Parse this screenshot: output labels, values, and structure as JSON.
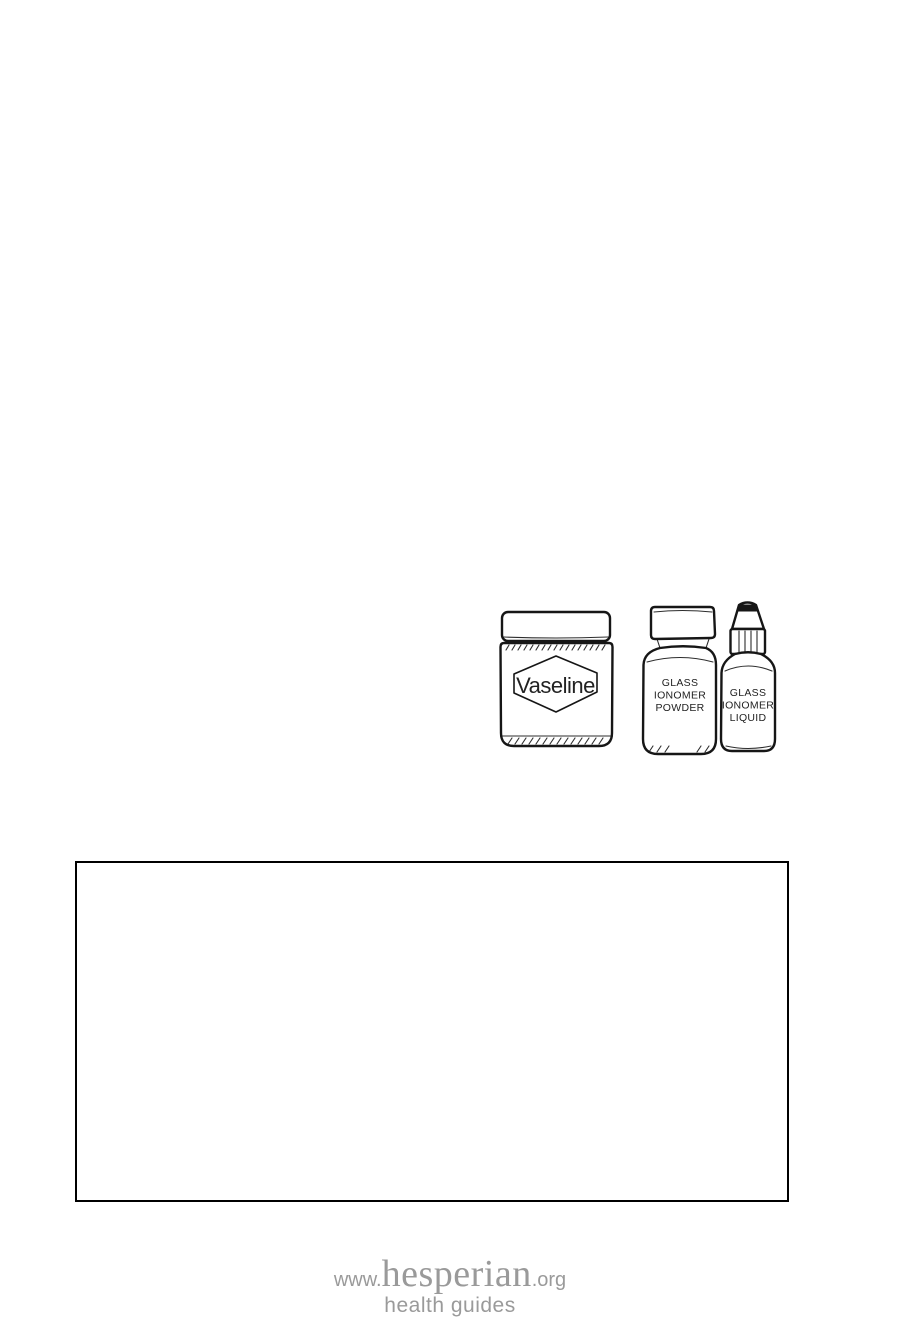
{
  "page": {
    "background": "#ffffff",
    "ink_color": "#161616"
  },
  "illustration": {
    "description": "line drawing of petroleum jelly jar, glass ionomer powder bottle, and glass ionomer liquid dropper bottle",
    "vaseline_label": "Vaseline",
    "powder_lines": [
      "GLASS",
      "IONOMER",
      "POWDER"
    ],
    "liquid_lines": [
      "GLASS",
      "IONOMER",
      "LIQUID"
    ]
  },
  "note_box": {
    "border_color": "#000000",
    "content": ""
  },
  "footer_logo": {
    "www": "www.",
    "name": "hesperian",
    "tld": ".org",
    "tagline": "health guides",
    "color": "#9a9a9a"
  }
}
